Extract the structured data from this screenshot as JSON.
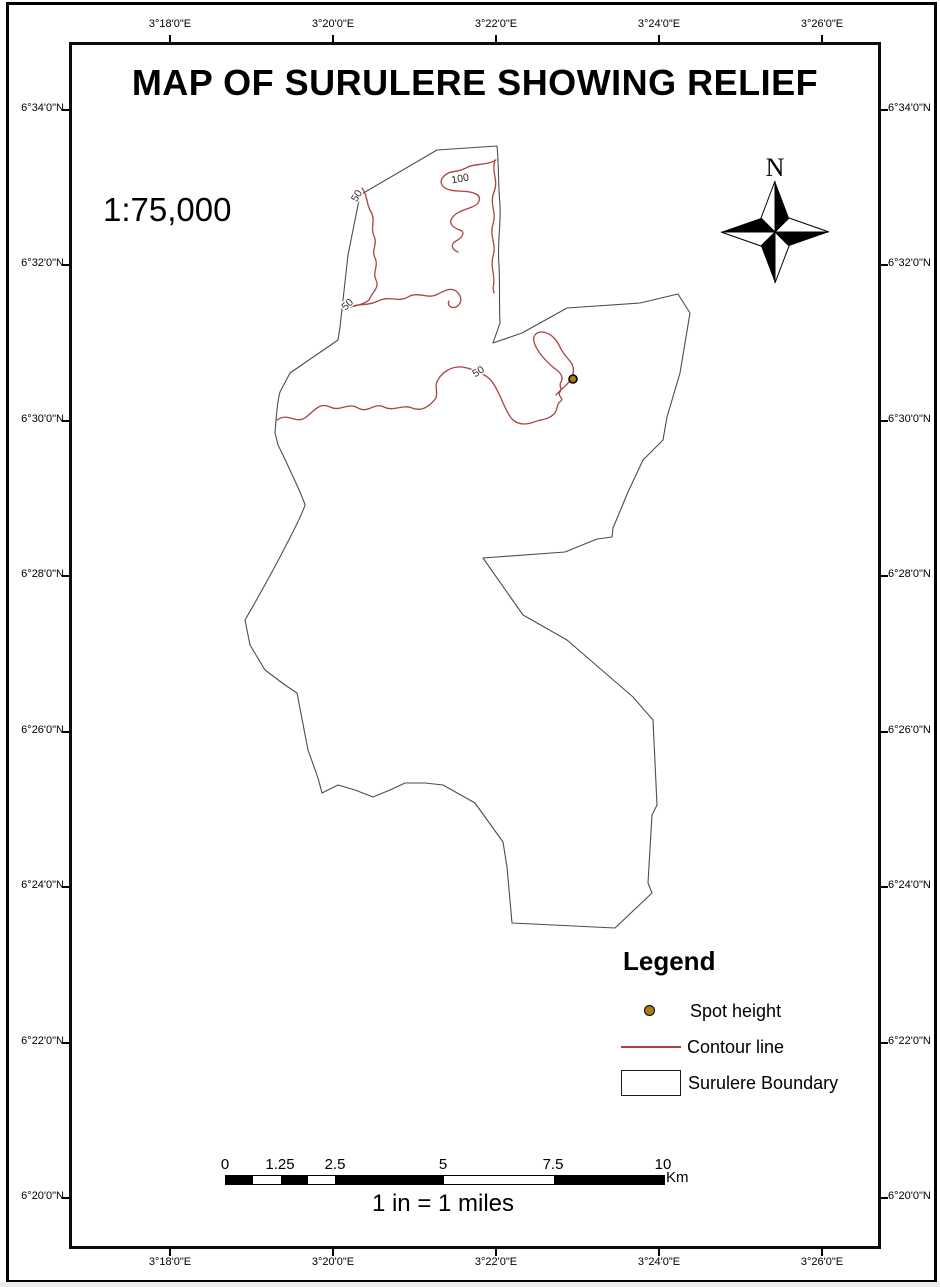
{
  "title": "MAP OF SURULERE SHOWING RELIEF",
  "scale_ratio": "1:75,000",
  "north_arrow": {
    "label": "N"
  },
  "graticule": {
    "longitude_labels": [
      "3°18'0\"E",
      "3°20'0\"E",
      "3°22'0\"E",
      "3°24'0\"E",
      "3°26'0\"E"
    ],
    "latitude_labels": [
      "6°34'0\"N",
      "6°32'0\"N",
      "6°30'0\"N",
      "6°28'0\"N",
      "6°26'0\"N",
      "6°24'0\"N",
      "6°22'0\"N",
      "6°20'0\"N"
    ]
  },
  "map": {
    "contour_labels": {
      "c50a": "50",
      "c100": "100",
      "c50b": "50",
      "c50c": "50"
    },
    "contour_color": "#a84442",
    "spot_height_color": "#ab7a10",
    "boundary_color": "#4d4d4d"
  },
  "legend": {
    "heading": "Legend",
    "items": {
      "spot": "Spot height",
      "contour": "Contour line",
      "boundary": "Surulere Boundary"
    }
  },
  "scalebar": {
    "labels": [
      "0",
      "1.25",
      "2.5",
      "5",
      "7.5",
      "10"
    ],
    "unit": "Km",
    "caption": "1 in = 1 miles"
  }
}
